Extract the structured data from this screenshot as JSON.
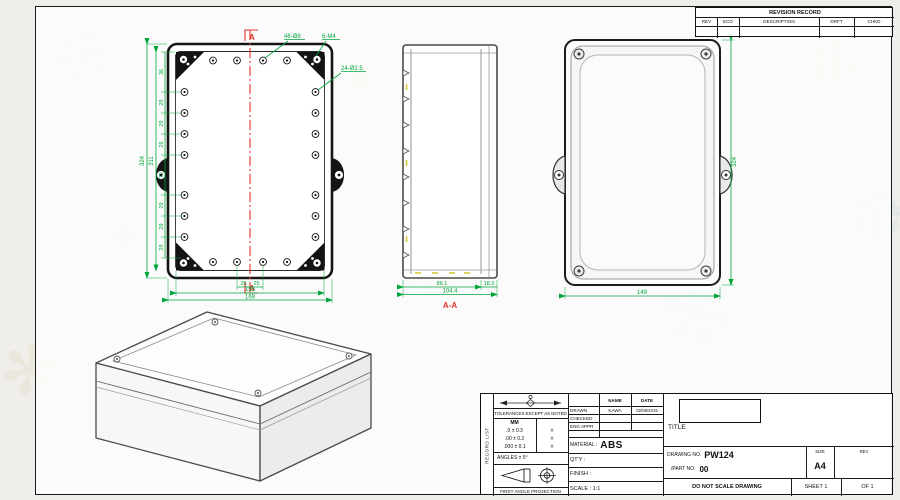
{
  "colors": {
    "dimension_green": "#00a63c",
    "section_red": "#e03228",
    "line_dark": "#1a1a1a"
  },
  "decor": {
    "glyphs": [
      "❄",
      "✳",
      "✻",
      "❆"
    ]
  },
  "revision_table": {
    "title": "REVISION RECORD",
    "columns": [
      "REV",
      "ECO",
      "DESCRIPTION",
      "DRFT",
      "CHKD"
    ]
  },
  "front_view": {
    "section_marker": "A",
    "ann_holes_1": "46-Ø8",
    "ann_holes_2": "6-M4",
    "ann_holes_3": "24-Ø2.5",
    "dim_chain_left": [
      "36",
      "29",
      "29",
      "29",
      "72",
      "29",
      "29",
      "29"
    ],
    "dim_inner_height": "311",
    "dim_overall_height": "324",
    "dim_hole_offset": "25",
    "dim_inner_width": "155",
    "dim_overall_width": "169"
  },
  "section_view": {
    "label": "A-A",
    "dim_body": "86.1",
    "dim_lip": "18.3",
    "dim_overall": "104.4"
  },
  "back_view": {
    "dim_width": "149",
    "dim_height": "324"
  },
  "title_block": {
    "side_label": "RECORD LIST",
    "tolerance_note": "TOLERANCES EXCEPT AS NOTED",
    "tol_unit": "MM",
    "tol_rows": [
      ".0 ± 0.3",
      ".00 ± 0.2",
      ".000 ± 0.1"
    ],
    "tol_pm": "±",
    "angles": "ANGLES ± 5°",
    "projection": "FIRST ANGLE PROJECTION",
    "col_name": "NAME",
    "col_date": "DATE",
    "drawn_label": "DRAWN",
    "drawn_name": "KAWA",
    "drawn_date": "02/05/2015",
    "checked_label": "CHECKED",
    "eng_appr_label": "ENG APPR",
    "material_label": "MATERIAL :",
    "material_value": "ABS",
    "qty_label": "QT'Y :",
    "finish_label": "FINISH :",
    "scale_text": "SCALE : 1:1",
    "title_label": "TITLE",
    "drawing_no_label": "DRAWING NO.",
    "drawing_no": "PW124",
    "part_no_label": "/PART NO.",
    "part_no": "00",
    "size_label": "SIZE",
    "size_value": "A4",
    "rev_label": "REV",
    "no_scale": "DO NOT SCALE DRAWING",
    "sheet": "SHEET 1",
    "of": "OF 1"
  }
}
